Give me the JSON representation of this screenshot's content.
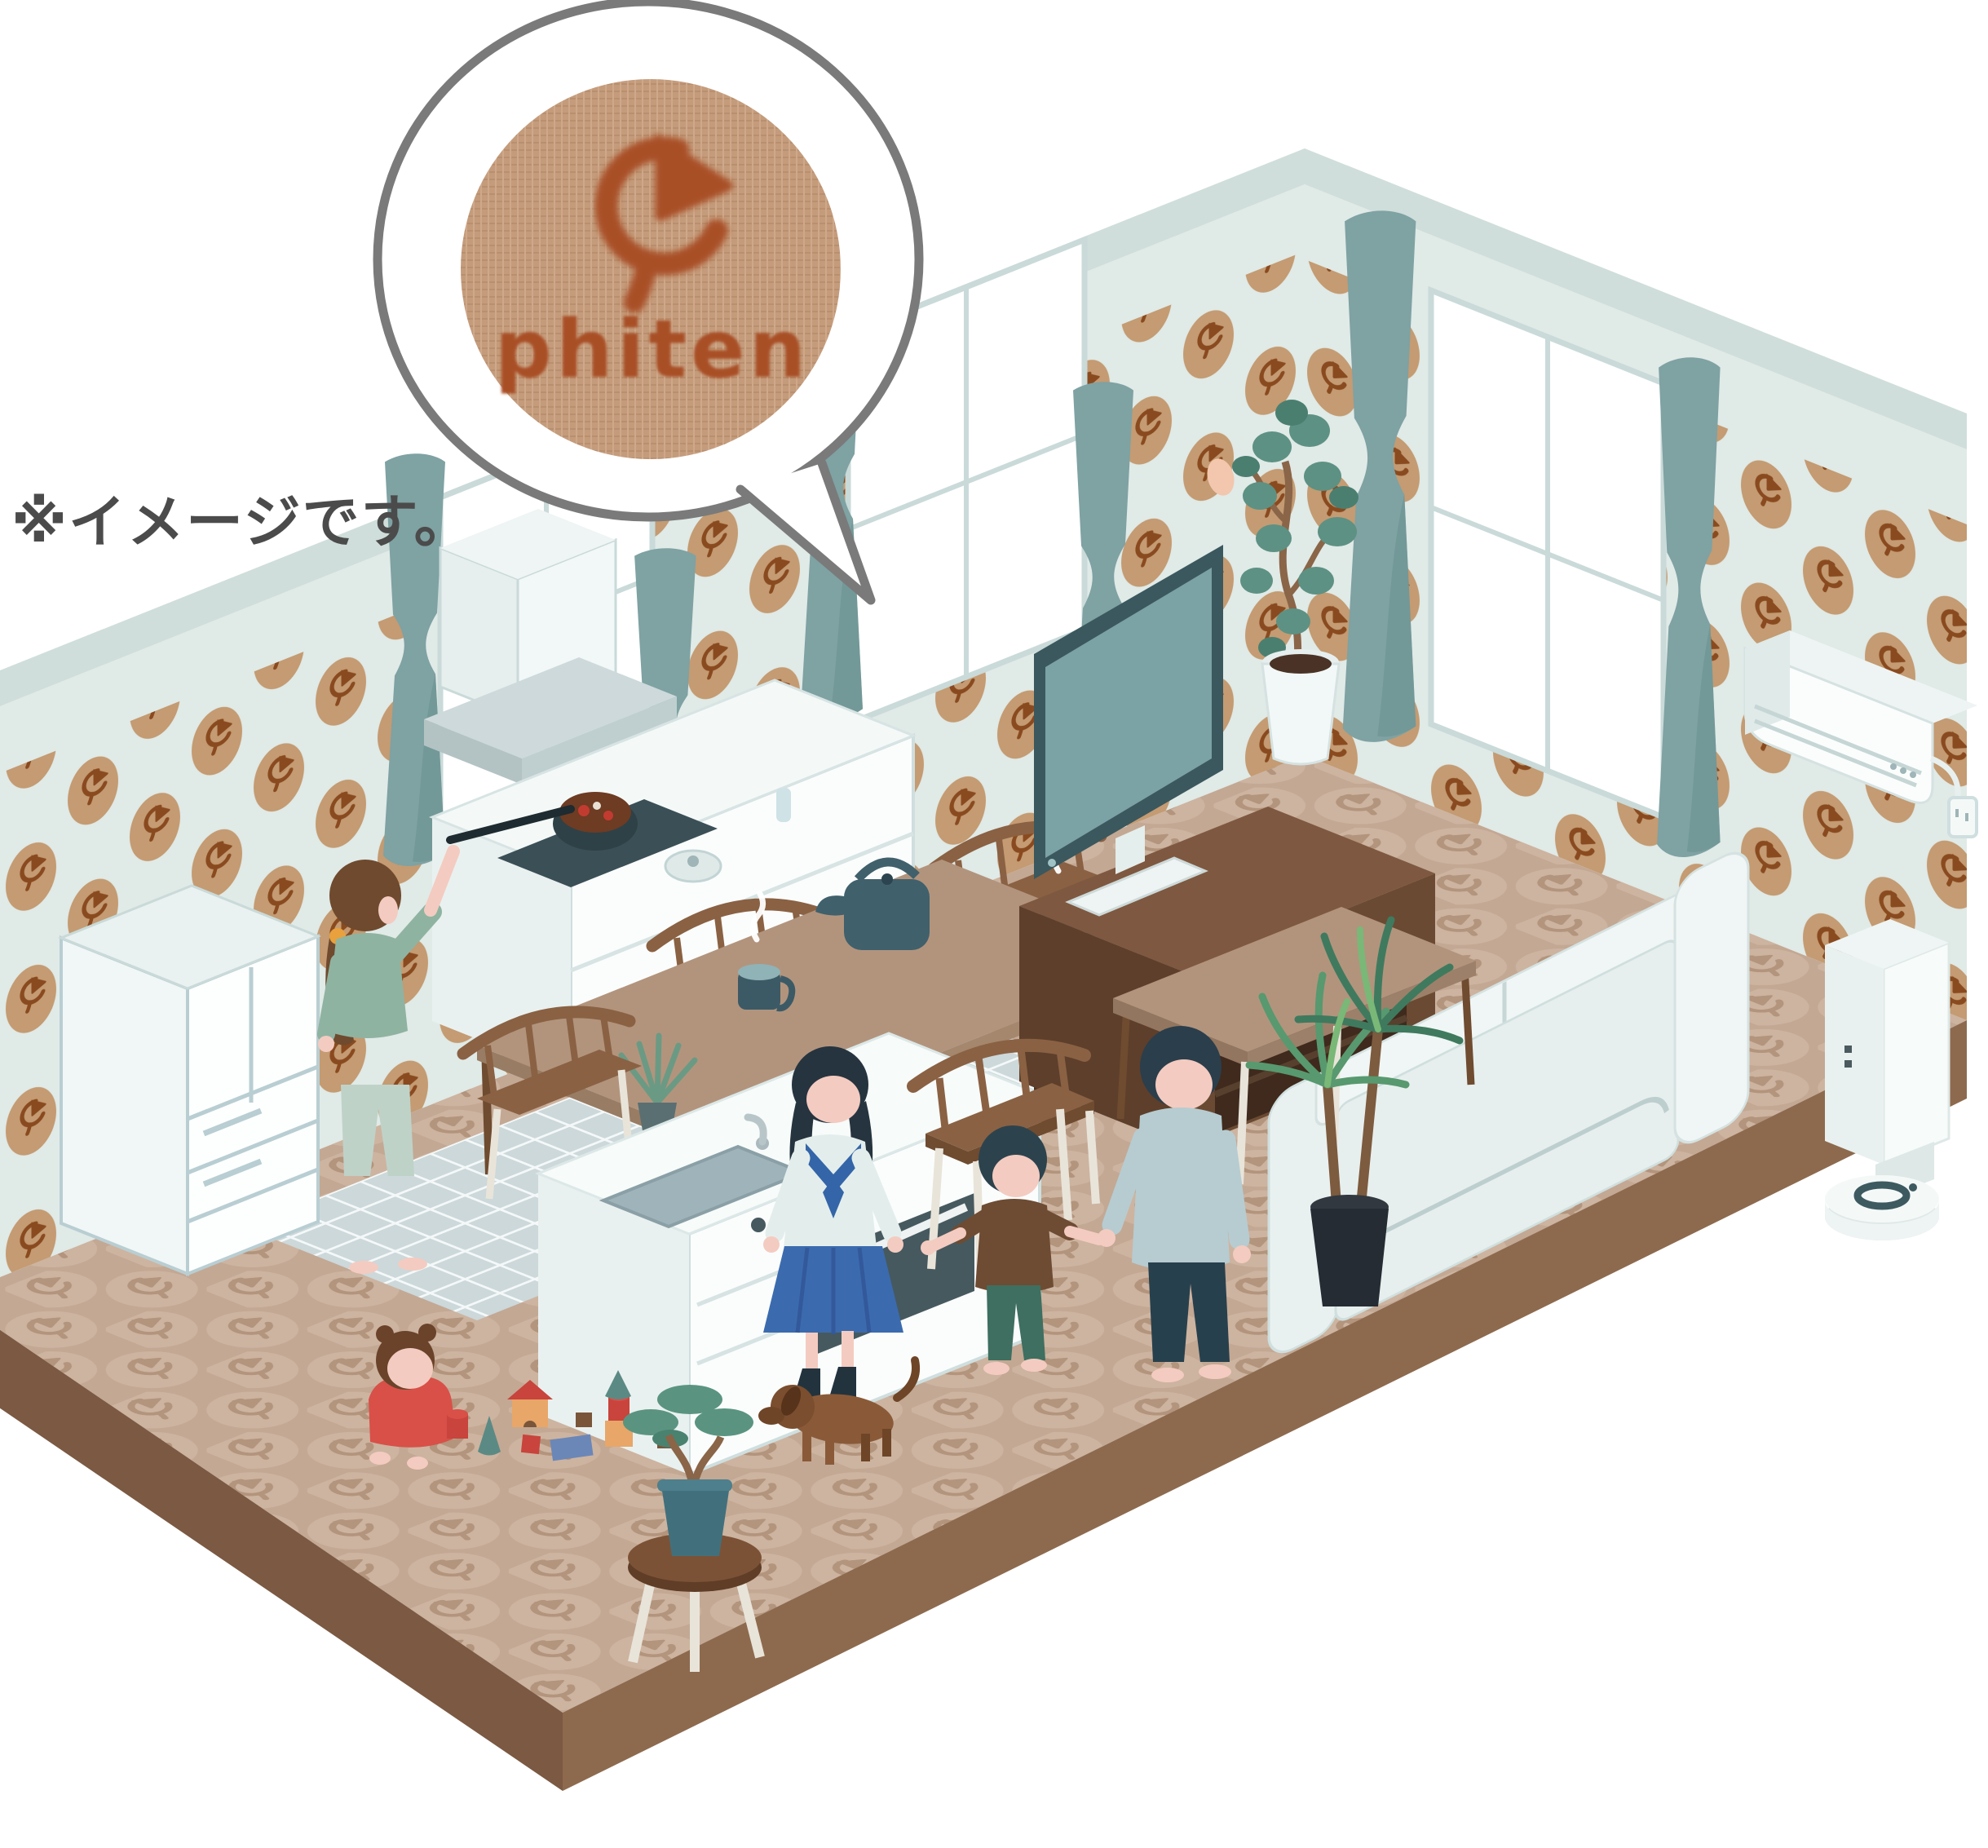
{
  "meta": {
    "type": "isometric-illustration",
    "subject": "Family living room and kitchen decorated with phiten logo patterned wallpaper and floor, with fabric swatch callout"
  },
  "texts": {
    "note": "※イメージです。",
    "brand": "phiten"
  },
  "palette": {
    "background": "#ffffff",
    "wall": "#e0eae7",
    "wallTopBand": "#cfdeda",
    "wallpaperOval": "#c49b72",
    "wallpaperMark": "#8a4a1f",
    "floor": "#c3a894",
    "floorCircle": "#cdb4a0",
    "floorMark": "#b3947c",
    "floorSideLight": "#8d6a4e",
    "floorSideDark": "#7b5942",
    "kitchenTile": "#ccd8da",
    "tileLine": "#f4f8f8",
    "teal": "#7fa2a3",
    "tealDark": "#6a8f90",
    "frame": "#c9dad9",
    "white": "#fbfdfd",
    "whiteShade": "#e9f1f0",
    "wood": "#8a6143",
    "woodDark": "#6f4b30",
    "tableTan": "#b2947d",
    "tvFrame": "#3a585e",
    "tvScreen": "#7ba2a5",
    "cabinet": "#6b4a33",
    "cabinetDark": "#3f2a1d",
    "slate": "#40606c",
    "slateDark": "#2e4147",
    "skin": "#f4cbc0",
    "hairBrown": "#6f4a2e",
    "hairDark": "#2b3e4b",
    "sageTop": "#8fb3a1",
    "sagePants": "#bfd2c8",
    "sailorBlue": "#3465a8",
    "skirtBlue": "#3b6bae",
    "uniformWhite": "#e3eeec",
    "sockNavy": "#22333e",
    "shirtGray": "#b6ccd1",
    "pantsNavy": "#27404d",
    "teeBrown": "#6e4b33",
    "pantsGreen": "#3e6f60",
    "babyRed": "#d85048",
    "dogBrown": "#8a5a38",
    "dogDark": "#6f4527",
    "leafGreen": "#5d9183",
    "leafDark": "#4a7f70",
    "yuccaGreen": "#58996f",
    "trunk": "#8a6548",
    "potBlack": "#252c33",
    "potTeal": "#41707c",
    "stoolWood": "#7c5236",
    "legCream": "#e9e4d9",
    "fabricTan": "#c49c7c",
    "logoRust": "#a94f28",
    "bubbleStroke": "#7a7a7a",
    "noteGray": "#4b4b4b",
    "accentOrange": "#e8a13d",
    "toyRed": "#c8443c",
    "toyOrange": "#e8a668",
    "toyTeal": "#5b8a84",
    "toyBlue": "#6b87b8"
  },
  "scene": {
    "objects": [
      "speech-bubble-fabric-swatch",
      "phiten-logo-mark",
      "wallpaper-phiten-pattern",
      "floor-phiten-pattern",
      "refrigerator",
      "range-hood",
      "stove-counter",
      "cooking-pot",
      "kitchen-island",
      "sink",
      "oven",
      "dining-table",
      "kettle",
      "steaming-mugs",
      "wooden-chairs",
      "tv",
      "tv-stand",
      "ficus-plant",
      "sofa",
      "coffee-table",
      "yucca-plant",
      "air-conditioner",
      "power-outlet",
      "air-purifier",
      "robot-vacuum",
      "mother-cooking",
      "daughter-school-uniform",
      "father",
      "son",
      "baby",
      "toy-blocks",
      "bonsai-on-stool",
      "dachshund-dog",
      "windows",
      "curtains",
      "kitchen-tile-floor"
    ]
  }
}
